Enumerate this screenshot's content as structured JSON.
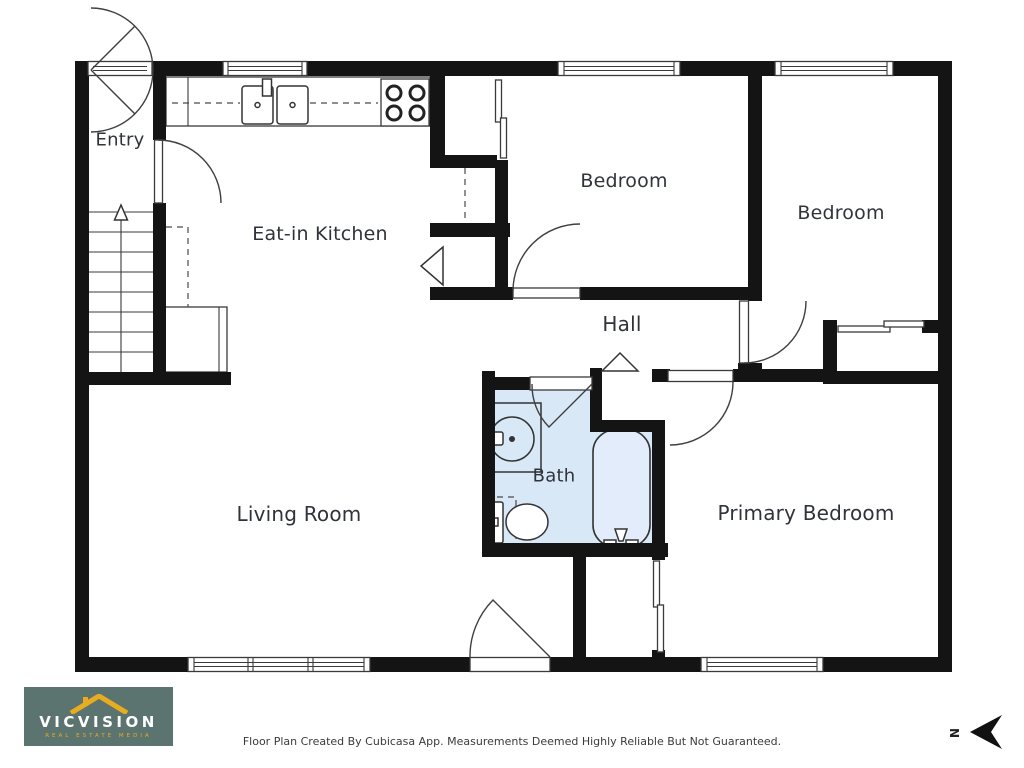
{
  "plan": {
    "rooms": {
      "entry": {
        "label": "Entry"
      },
      "kitchen": {
        "label": "Eat-in Kitchen"
      },
      "bedroom_top": {
        "label": "Bedroom"
      },
      "bedroom_right": {
        "label": "Bedroom"
      },
      "hall": {
        "label": "Hall"
      },
      "bath": {
        "label": "Bath"
      },
      "living_room": {
        "label": "Living Room"
      },
      "primary_bedroom": {
        "label": "Primary Bedroom"
      }
    },
    "colors": {
      "wall": "#141414",
      "bath_fill": "#d9e8f7",
      "line": "#3a3a3a",
      "label": "#30343a"
    }
  },
  "branding": {
    "name": "VICVISION",
    "tagline": "REAL ESTATE MEDIA",
    "bg_color": "#5b7470",
    "accent_color": "#e7ac1f"
  },
  "footer": {
    "disclaimer": "Floor Plan Created By Cubicasa App. Measurements Deemed Highly Reliable But Not Guaranteed."
  },
  "compass": {
    "north_label": "N"
  }
}
